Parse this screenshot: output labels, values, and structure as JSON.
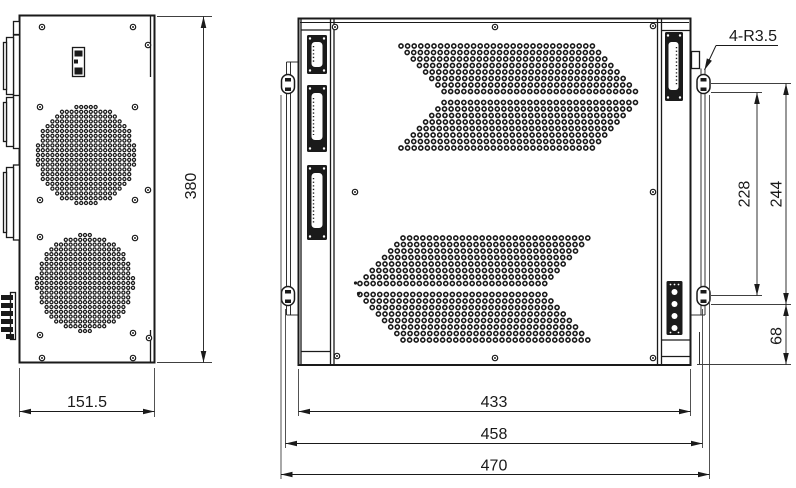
{
  "colors": {
    "background": "#ffffff",
    "line": "#1a1a1a"
  },
  "dimensions": {
    "side_width": "151.5",
    "height": "380",
    "rear_body_width": "433",
    "rear_flange_width": "458",
    "rear_overall_width": "470",
    "slot_span_inner": "228",
    "slot_span_outer": "244",
    "slot_bottom_offset": "68",
    "mount_slot_note": "4-R3.5"
  }
}
